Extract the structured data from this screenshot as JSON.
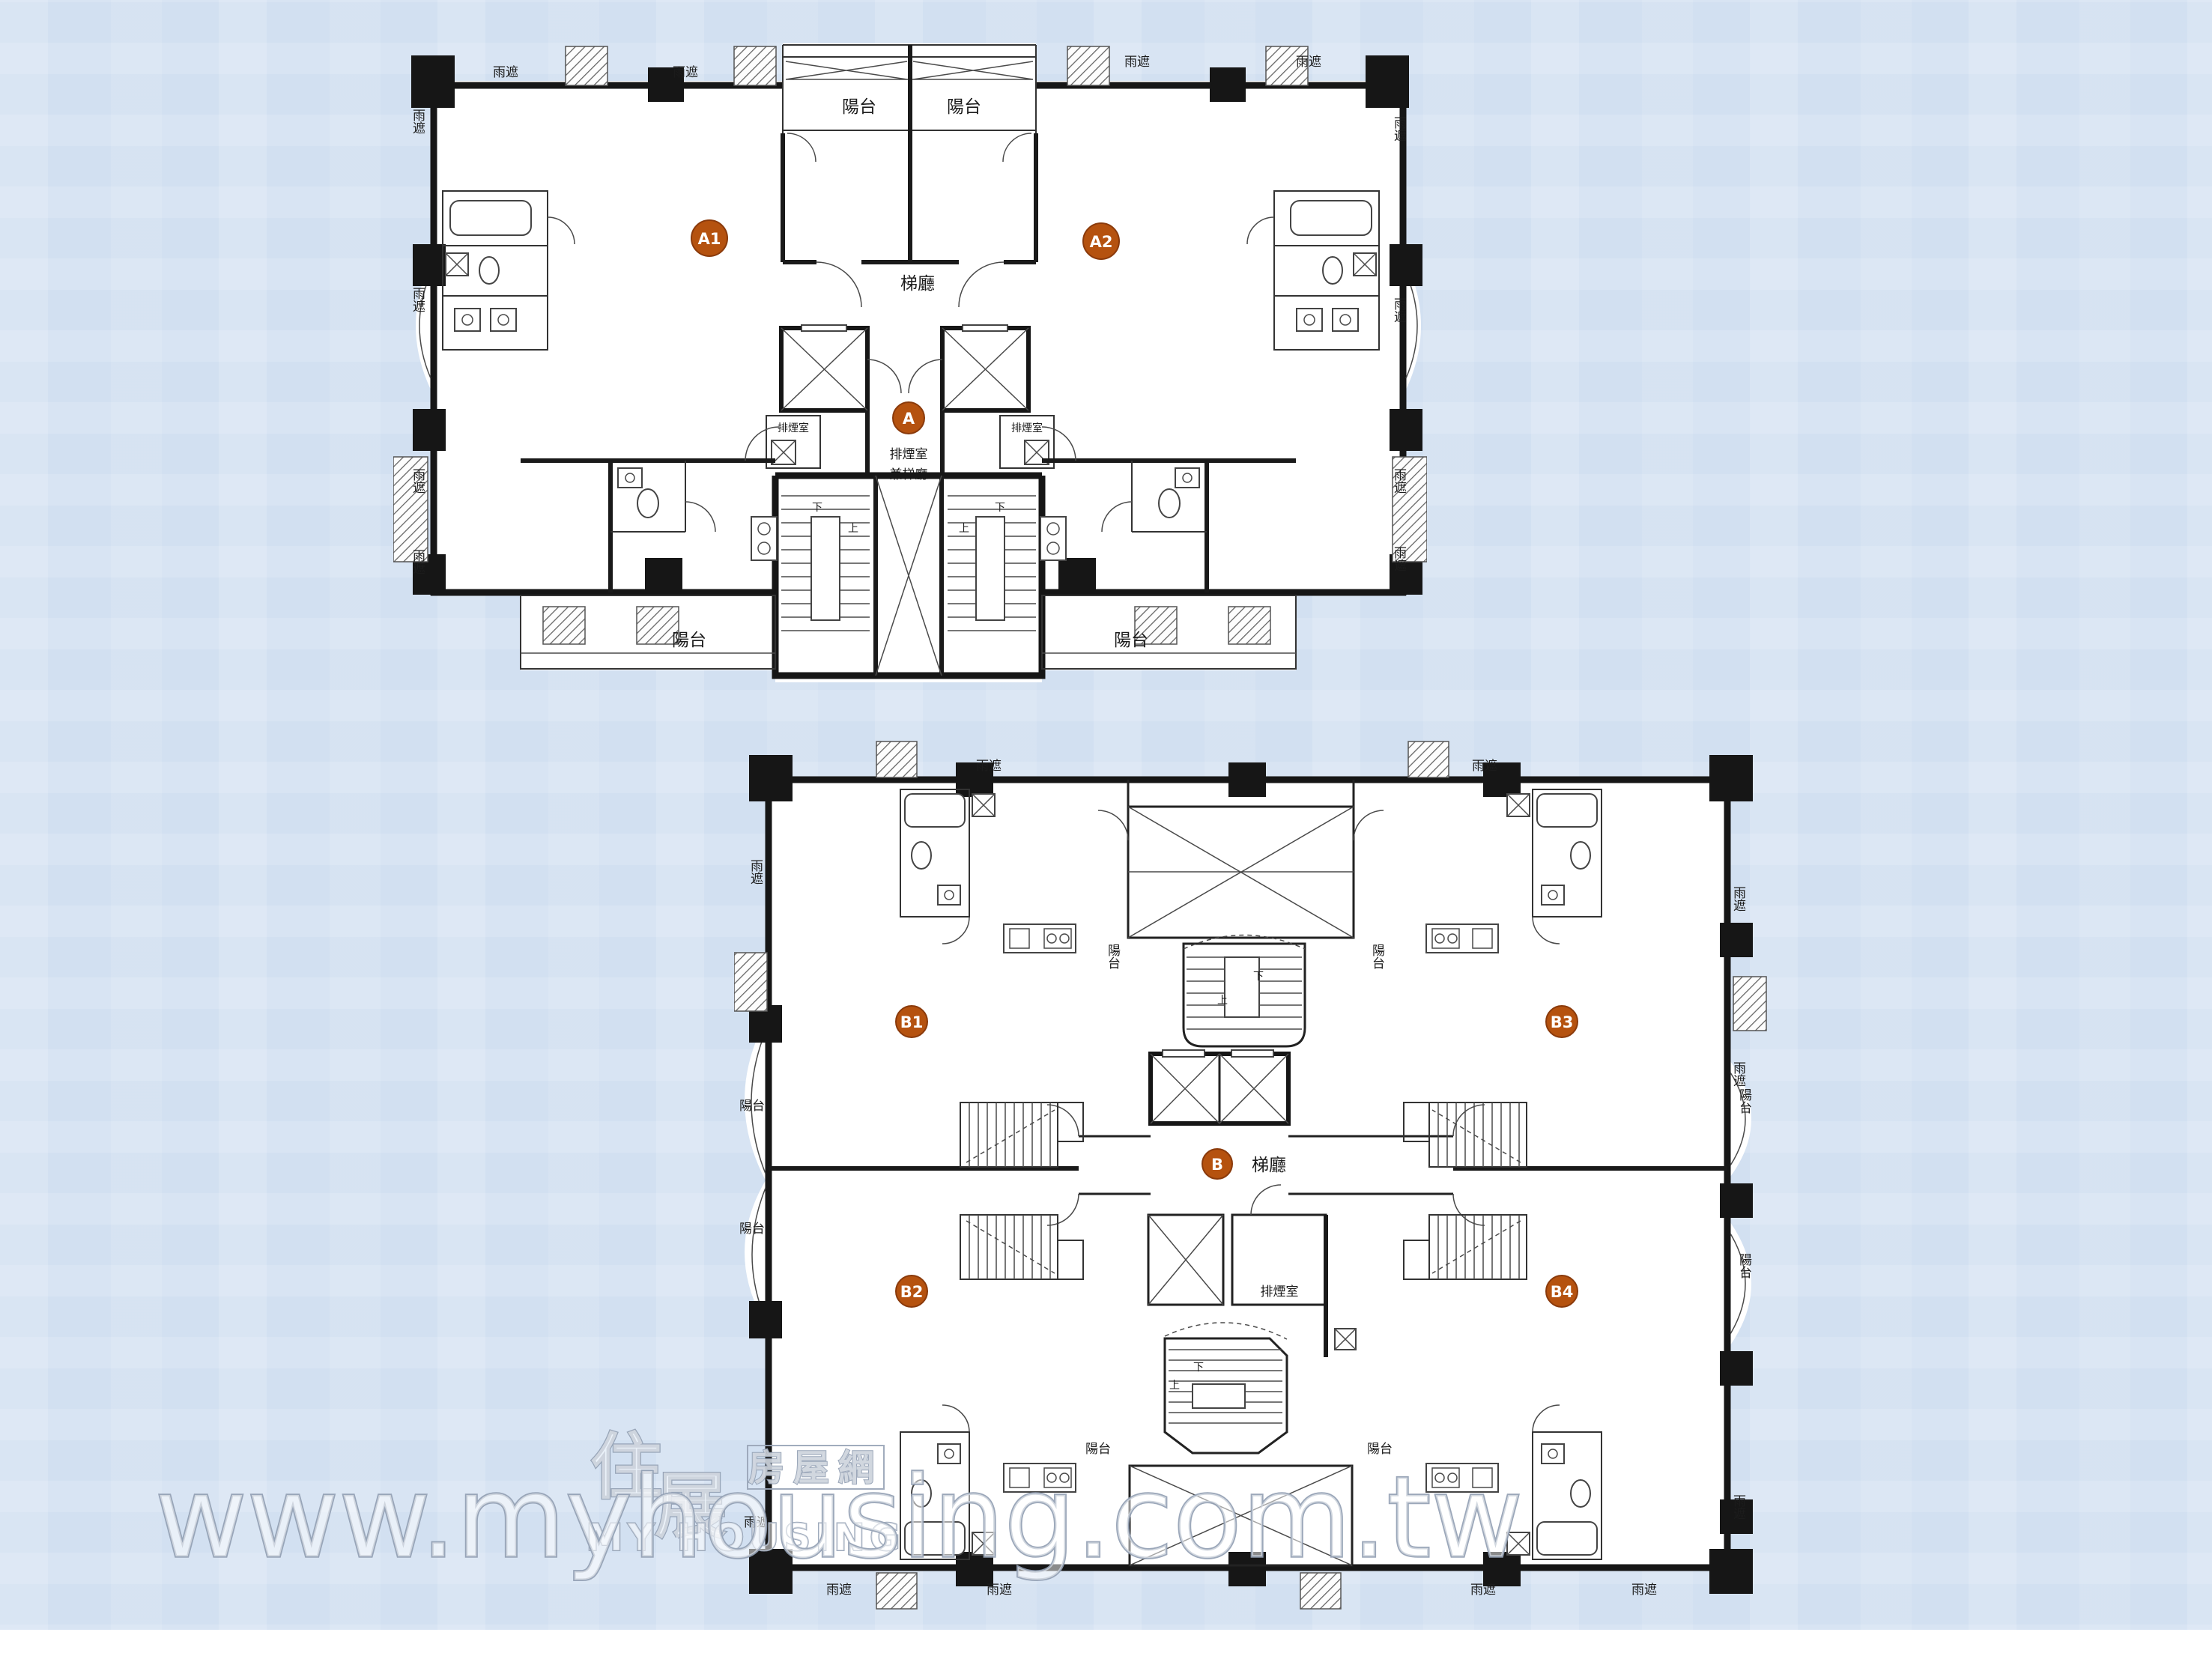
{
  "page": {
    "background_color": "#d2e0f1",
    "bottom_strip_color": "#ffffff"
  },
  "accent": {
    "badge_fill": "#b5520f",
    "badge_stroke": "#8a3a0b",
    "badge_text_color": "#ffffff",
    "wall_color": "#161616"
  },
  "labels": {
    "rain_cover": "雨遮",
    "balcony": "陽台",
    "lift_lobby": "梯廳",
    "smoke_room": "排煙室",
    "smoke_lobby_line1": "排煙室",
    "smoke_lobby_line2": "兼梯廳",
    "up": "上",
    "down": "下"
  },
  "plan_a": {
    "core_badge": "A",
    "units": [
      {
        "id": "A1"
      },
      {
        "id": "A2"
      }
    ]
  },
  "plan_b": {
    "core_badge": "B",
    "units": [
      {
        "id": "B1"
      },
      {
        "id": "B2"
      },
      {
        "id": "B3"
      },
      {
        "id": "B4"
      }
    ]
  },
  "watermark": {
    "logo_char1": "住",
    "logo_char2": "展",
    "logo_site_name": "房屋網",
    "logo_en": "MY HOUSING",
    "url": "www.myhousing.com.tw"
  }
}
